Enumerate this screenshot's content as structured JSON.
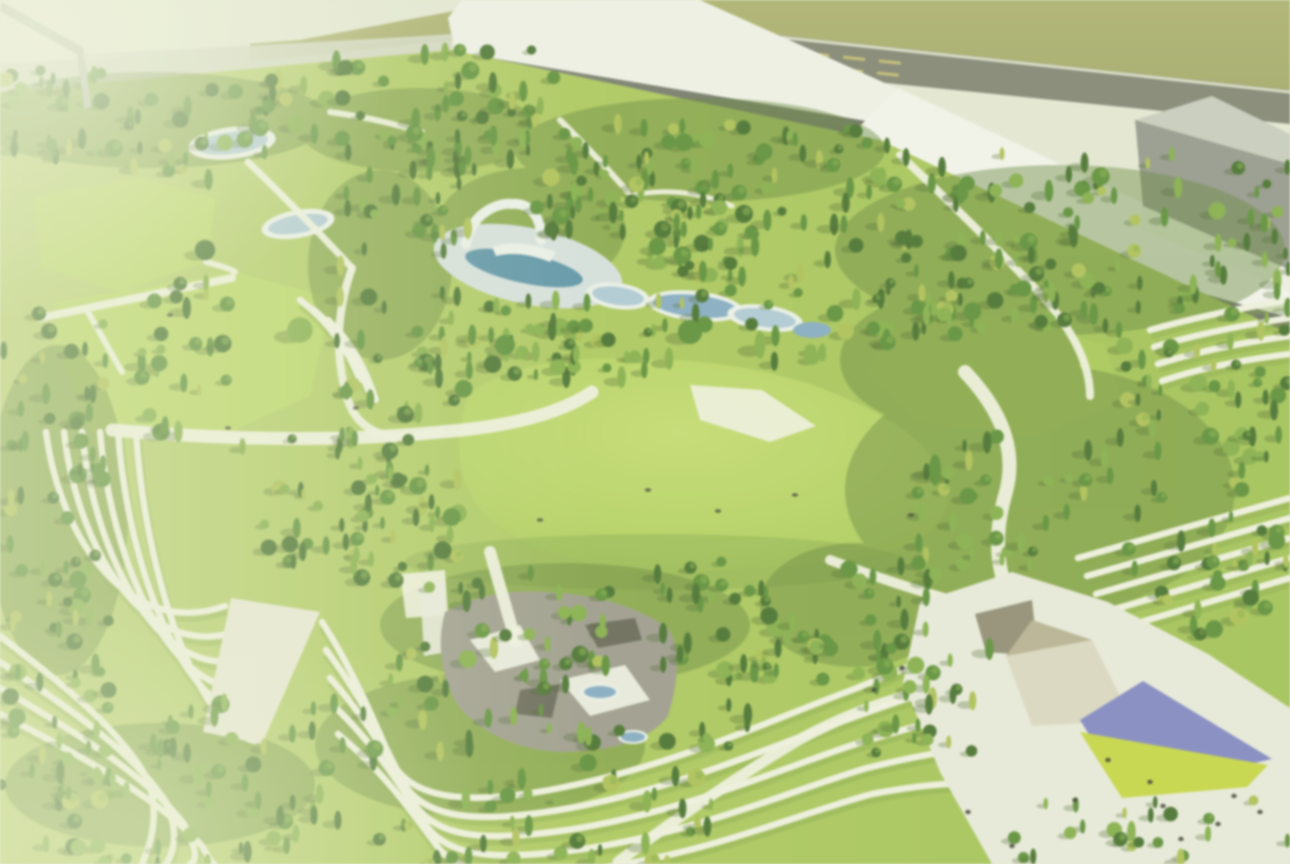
{
  "scene": {
    "type": "aerial-architectural-render",
    "subject": "Blurred bird's-eye rendering of a landscaped park masterplan: terraced lawns with white contour paths, dense tree groves, a central meadow, an amphitheater pool with white arch pavilion and cascading ponds, a plaza with angular tan canopies and purple/yellow kite-shaped paving, bordered along the top by flat-roofed industrial buildings and a road with yellow lane markings",
    "no_text_visible": true
  },
  "palette": {
    "backdrop": "#e3e7d5",
    "beam": "#b2b8ac",
    "pale_strip": "#ced3c0",
    "olive_field": "#a1a763",
    "olive_field_light": "#abb06c",
    "road": "#7b7e70",
    "road_shoulder": "#d8dbc8",
    "road_marking": "#cfc46a",
    "roof_white": "#eff1ea",
    "roof_white2": "#f3f4ef",
    "fascia_dark": "#6e7268",
    "fascia_dark2": "#5d6157",
    "court": "#a9ada1",
    "box_front": "#8f938a",
    "box_top": "#c5c9be",
    "parapet": "#edefe6",
    "grass_base": "#a7c653",
    "grass_left": "#b4cd68",
    "grass_light": "#bcd765",
    "lawn_bright": "#b5d45c",
    "meadow_edge": "#a3c64d",
    "meadow_shadow": "#6d9438",
    "canopy_bed": "#587e2f",
    "tree_dark": "#3c6a24",
    "tree_mid": "#528a2d",
    "tree_light": "#7cab3e",
    "tree_yellow": "#a8bd4a",
    "tree_shadow": "#39551f",
    "path_white": "#eef0e0",
    "path_warm": "#e8e7d6",
    "terrace_shade": "#7da23c",
    "water_deep": "#4f8da8",
    "water_steel": "#7ba6c6",
    "water_light": "#a9c6d8",
    "deck": "#d4dfe0",
    "rim_white": "#eaf0ec",
    "rock_gray": "#98968a",
    "rock_dark": "#605f53",
    "rock_light": "#e8eadf",
    "plaza_paving": "#e7e9dc",
    "canopy_tan": "#b3ad8f",
    "canopy_beige": "#d9d5c1",
    "canopy_dark": "#8b8770",
    "kite_purple": "#7b80c8",
    "kite_yellow": "#c3d437",
    "dot_dark": "#2e2f28"
  },
  "counts": {
    "buildings": 3,
    "tree_clusters": 24,
    "trees_approx": 1050,
    "terrace_line_groups": 7,
    "ponds": 8,
    "people_dots": 12,
    "meadow_dots": 8
  }
}
